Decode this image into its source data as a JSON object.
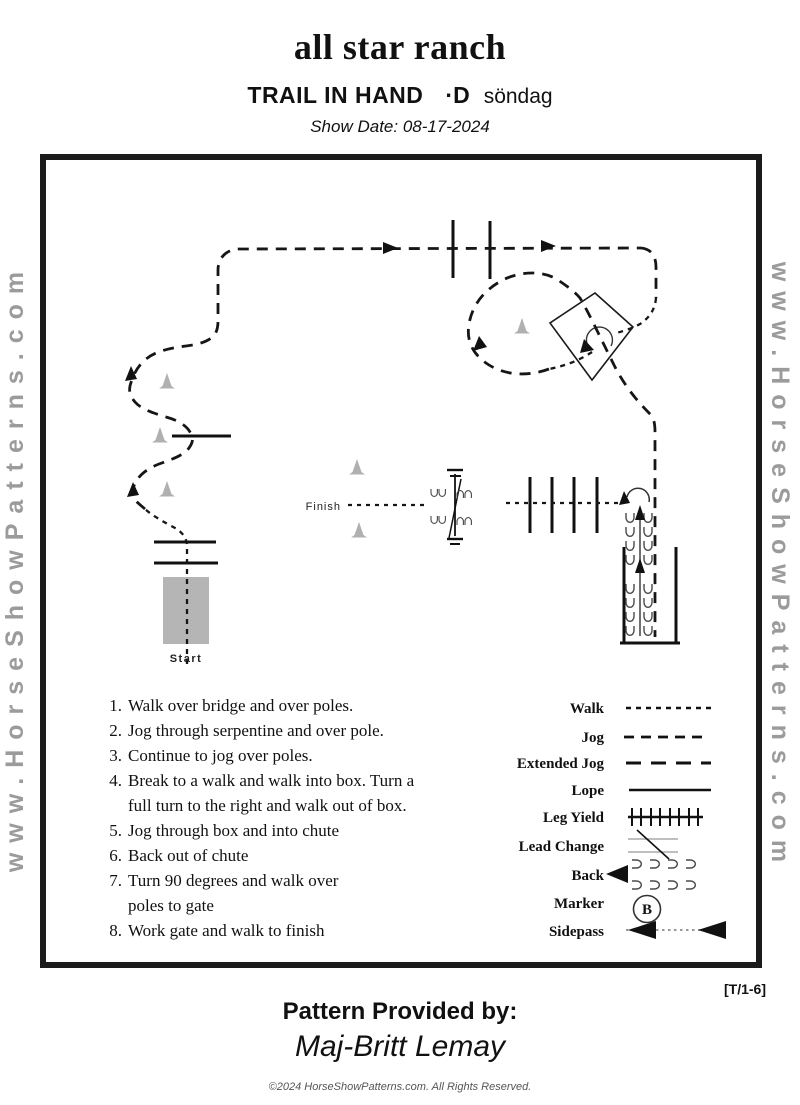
{
  "header": {
    "ranch": "all star ranch",
    "class_name": "TRAIL IN HAND",
    "division": "·D",
    "day": "söndag",
    "show_date": "Show Date: 08-17-2024"
  },
  "watermark": {
    "text": "www.HorseShowPatterns.com"
  },
  "pattern": {
    "start_label": "Start",
    "finish_label": "Finish"
  },
  "instructions": [
    {
      "num": "1.",
      "line1": "Walk over bridge and over poles."
    },
    {
      "num": "2.",
      "line1": "Jog through serpentine and over pole."
    },
    {
      "num": "3.",
      "line1": "Continue to jog over poles."
    },
    {
      "num": "4.",
      "line1": "Break to a walk and walk into box.  Turn a",
      "line2": "full turn to the right and walk out of box."
    },
    {
      "num": "5.",
      "line1": "Jog through box and into chute"
    },
    {
      "num": "6.",
      "line1": "Back out of chute"
    },
    {
      "num": "7.",
      "line1": "Turn 90 degrees and walk over",
      "line2": "poles to gate"
    },
    {
      "num": "8.",
      "line1": "Work gate and walk to finish"
    }
  ],
  "legend": {
    "labels": [
      "Walk",
      "Jog",
      "Extended Jog",
      "Lope",
      "Leg Yield",
      "Lead Change",
      "Back",
      "Marker",
      "Sidepass"
    ],
    "marker_letter": "B"
  },
  "footer": {
    "tag": "[T/1-6]",
    "provided_label": "Pattern Provided by:",
    "provider": "Maj-Britt Lemay",
    "copyright": "©2024 HorseShowPatterns.com. All Rights Reserved."
  },
  "colors": {
    "line": "#1a1a1a",
    "cone": "#b0b0b0",
    "bridge": "#b5b5b5",
    "watermark": "#9b9b9b"
  }
}
